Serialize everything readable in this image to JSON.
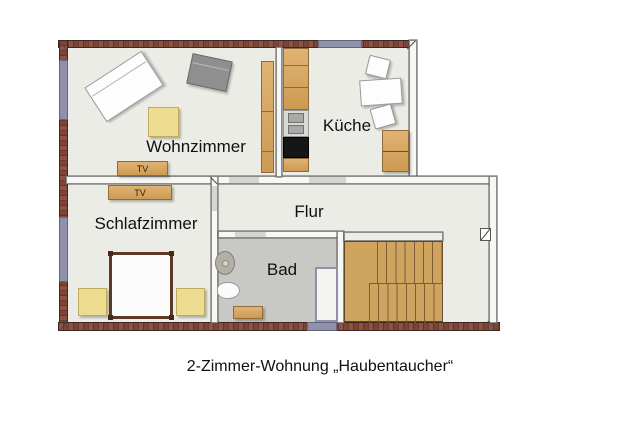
{
  "plan": {
    "caption": "2-Zimmer-Wohnung „Haubentaucher“",
    "rooms": {
      "wohnzimmer": "Wohnzimmer",
      "kueche": "Küche",
      "schlafzimmer": "Schlafzimmer",
      "flur": "Flur",
      "bad": "Bad"
    },
    "labels": {
      "tv_wohnzimmer": "TV",
      "tv_schlafzimmer": "TV"
    },
    "colors": {
      "floor": "#ecece6",
      "bathroom_floor": "#c8c8c5",
      "brick_wall": "#7c4437",
      "window": "#8f90a9",
      "wood": "#d6a862",
      "accent_yellow": "#eedc90",
      "stove": "#161616",
      "bed_frame": "#5c3a26"
    }
  }
}
